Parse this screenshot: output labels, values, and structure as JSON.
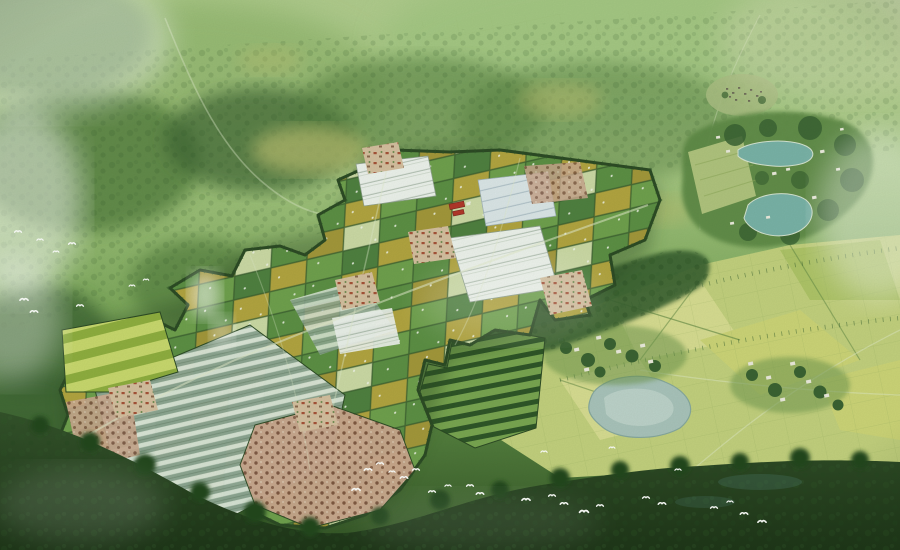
{
  "page": {
    "width_px": 900,
    "height_px": 550
  },
  "scene": {
    "subject": "Bird's-eye watercolor-style master-plan rendering of a rural agricultural eco-park",
    "style": "aerial perspective rendering, hazy green tones, no text",
    "regions": [
      {
        "id": "distant-hills",
        "label": "Misty forested hills and distant field traces"
      },
      {
        "id": "northeast-resort",
        "label": "Wooded leisure village with two teal ponds and small buildings"
      },
      {
        "id": "north-hamlet",
        "label": "Small distant hamlet in the trees"
      },
      {
        "id": "agri-park",
        "label": "Planned agricultural park: checkerboard crop plots, greenhouse rows, white greenhouse blocks, orchards and farm villages inside a dark tree boundary"
      },
      {
        "id": "red-building",
        "label": "Red-roofed farm facility inside the park"
      },
      {
        "id": "vineyard-rows",
        "label": "Dark crop rows south-east of the park"
      },
      {
        "id": "southeast-fields",
        "label": "Open light-green farmland with a grey pond and two tree-shaded villages"
      },
      {
        "id": "foreground-woods",
        "label": "Dark tree belt in the foreground"
      },
      {
        "id": "bird-flocks",
        "label": "Flocks of white egrets over meadow and foreground"
      },
      {
        "id": "mist",
        "label": "Low white mist patches on the left and warm haze top-right"
      }
    ]
  },
  "palette": {
    "bg_top": "#c6d8aa",
    "bg_upper": "#a3c47f",
    "bg_mid": "#7fa95e",
    "bg_low": "#547f3e",
    "bg_bottom": "#335426",
    "hill_soft": "#aecb8a",
    "hill_mid": "#8fb46c",
    "hill_pale": "#9ec47f",
    "hill_gold": "#b9bd6f",
    "forest": "#557f3f",
    "forest_dark": "#3a6232",
    "forest_deep": "#2e5527",
    "plot_green_a": "#5c8f44",
    "plot_green_b": "#6fa04d",
    "plot_green_c": "#4f8040",
    "plot_yellow_a": "#b2a440",
    "plot_yellow_b": "#a3973a",
    "plot_pale": "#ccd9a6",
    "plot_gap": "#3a5c2e",
    "plot_dot": "#f3f6ec",
    "gh_base": "#8fa795",
    "gh_stripe": "#dce6da",
    "white_base": "#eef2ee",
    "white_line": "#b5c2b6",
    "blue_base": "#dce6e9",
    "blue_line": "#aebfc8",
    "lime_a": "#c9d86e",
    "lime_b": "#8fae3f",
    "orchard_base": "#c9a78e",
    "orchard_dot": "#7f5742",
    "village_base": "#d5bfa0",
    "village_dot": "#a65238",
    "roof_red": "#b23729",
    "pond_teal": "#79b2a8",
    "pond_gray": "#a9c3bc",
    "pond_light": "#c6d9d2",
    "field_base": "#c3d07e",
    "field_light": "#d8dc92",
    "field_lime": "#cdd478",
    "field_dark": "#afc468",
    "hedge": "#5c8340",
    "vine_base": "#79a551",
    "vine_row": "#2e5527",
    "road": "#e2eacc",
    "boundary": "#2c4a24",
    "fg_top": "#33522a",
    "fg_bottom": "#1e3618",
    "house_white": "#eceade",
    "tree_dot_dark": "#24471f",
    "bird": "#ffffff",
    "mist": "#ffffff",
    "haze_warm": "#e8e4c8"
  }
}
